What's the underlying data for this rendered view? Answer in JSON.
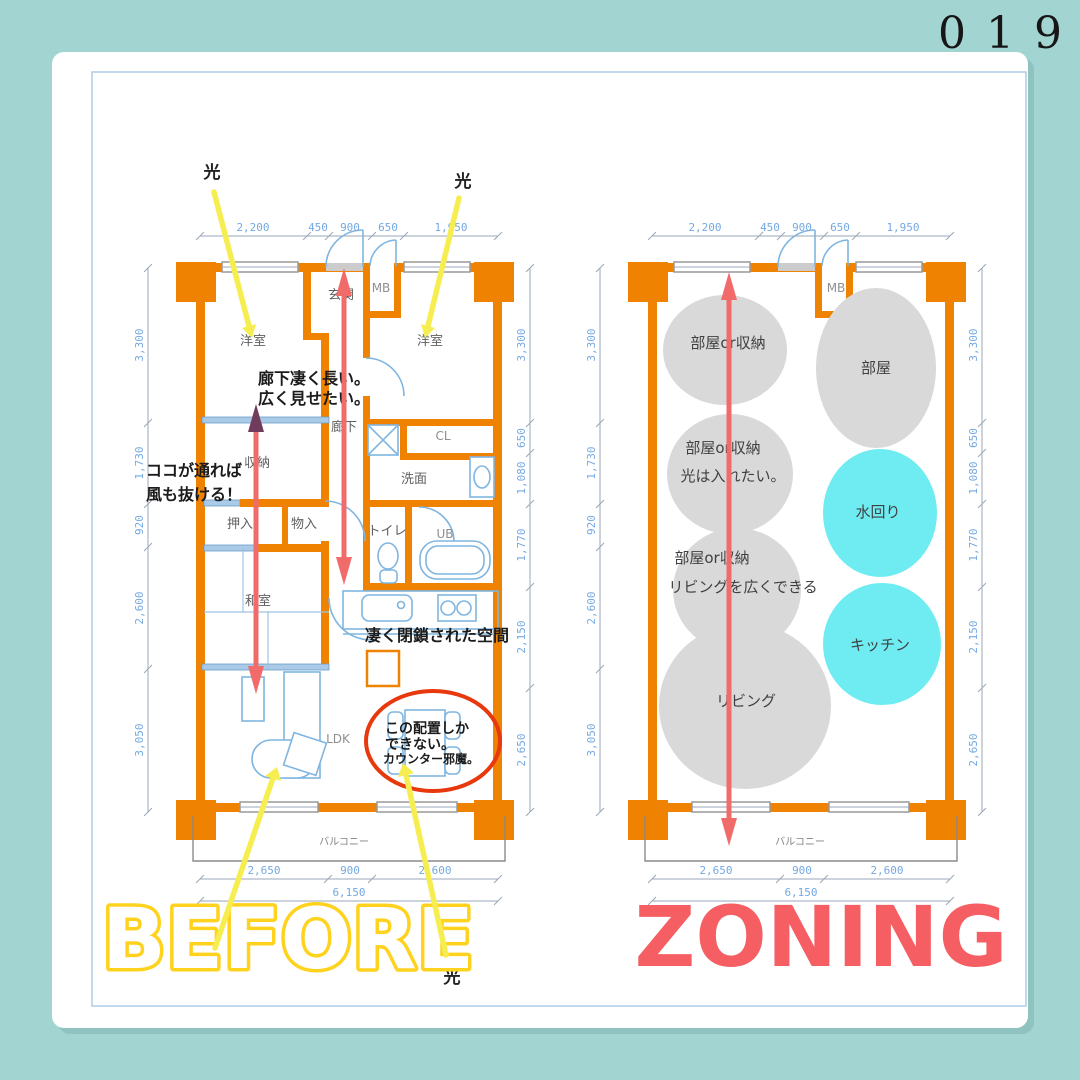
{
  "page": {
    "number": "019"
  },
  "titles": {
    "before": "BEFORE",
    "zoning": "ZONING"
  },
  "colors": {
    "frame_teal": "#A2D5D1",
    "wall_orange": "#EF8200",
    "zone_gray": "#D9D9D9",
    "zone_cyan": "#6FECF2",
    "arrow_red": "#F26B6B",
    "arrow_yellow": "#F6EE51",
    "title_yellow": "#FFD21E",
    "title_red": "#F55F63",
    "dim_text_blue": "#74A9E2",
    "plan_line_blue": "#7FB5E0",
    "highlight_red": "#E8380D"
  },
  "before": {
    "light": "光",
    "rooms": {
      "yoshitsu_left": "洋室",
      "yoshitsu_right": "洋室",
      "genkan": "玄関",
      "mb": "MB",
      "rouka": "廊下",
      "cl": "CL",
      "senmen": "洗面",
      "shuno": "収納",
      "oshiire": "押入",
      "mononyu": "物入",
      "toire": "トイレ",
      "ub": "UB",
      "washitsu": "和室",
      "ldk": "LDK",
      "balcony": "バルコニー"
    },
    "notes": {
      "corridor_line1": "廊下凄く長い。",
      "corridor_line2": "広く見せたい。",
      "wind_line1": "ココが通れば",
      "wind_line2": "風も抜ける！",
      "closed_space": "凄く閉鎖された空間",
      "layout_line1": "この配置しか",
      "layout_line2": "できない。",
      "layout_line3": "カウンター邪魔。"
    },
    "dims": {
      "top": [
        "2,200",
        "450",
        "900",
        "650",
        "1,950"
      ],
      "left": [
        "3,300",
        "1,730",
        "920",
        "2,600",
        "3,050"
      ],
      "right": [
        "3,300",
        "650",
        "1,080",
        "1,770",
        "2,150",
        "2,650"
      ],
      "bottom": [
        "2,650",
        "900",
        "2,600"
      ],
      "total": "6,150"
    }
  },
  "zoning": {
    "rooms": {
      "mb": "MB",
      "balcony": "バルコニー"
    },
    "zones": {
      "z1": "部屋or収納",
      "z2": "部屋",
      "z3_line1": "部屋or収納",
      "z3_line2": "光は入れたい。",
      "z4": "水回り",
      "z5_line1": "部屋or収納",
      "z5_line2": "リビングを広くできる",
      "z6": "キッチン",
      "z7": "リビング"
    },
    "dims": {
      "top": [
        "2,200",
        "450",
        "900",
        "650",
        "1,950"
      ],
      "left": [
        "3,300",
        "1,730",
        "920",
        "2,600",
        "3,050"
      ],
      "right": [
        "3,300",
        "650",
        "1,080",
        "1,770",
        "2,150",
        "2,650"
      ],
      "bottom": [
        "2,650",
        "900",
        "2,600"
      ],
      "total": "6,150"
    }
  }
}
